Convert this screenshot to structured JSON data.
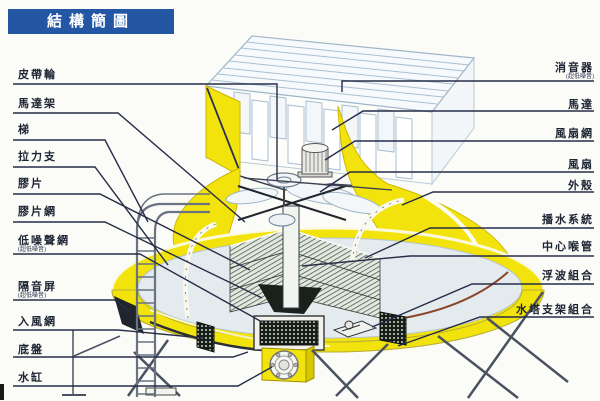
{
  "title": "結構簡圖",
  "labels": {
    "left": [
      {
        "text": "皮帶輪"
      },
      {
        "text": "馬達架"
      },
      {
        "text": "梯"
      },
      {
        "text": "拉力支"
      },
      {
        "text": "膠片"
      },
      {
        "text": "膠片網"
      },
      {
        "text": "低噪聲網",
        "sub": "(超低噪音)"
      },
      {
        "text": "隔音屏",
        "sub": "(超低噪音)"
      },
      {
        "text": "入風網"
      },
      {
        "text": "底盤"
      },
      {
        "text": "水缸"
      }
    ],
    "right": [
      {
        "text": "消音器",
        "sub": "(超低噪音)"
      },
      {
        "text": "馬達"
      },
      {
        "text": "風扇網"
      },
      {
        "text": "風扇"
      },
      {
        "text": "外殼"
      },
      {
        "text": "播水系統"
      },
      {
        "text": "中心喉管"
      },
      {
        "text": "浮波組合"
      },
      {
        "text": "水塔支架組合"
      }
    ]
  },
  "colors": {
    "banner_blue": "#2357a4",
    "shell_yellow": "#f3e30c",
    "leader_line": "#262d48"
  }
}
